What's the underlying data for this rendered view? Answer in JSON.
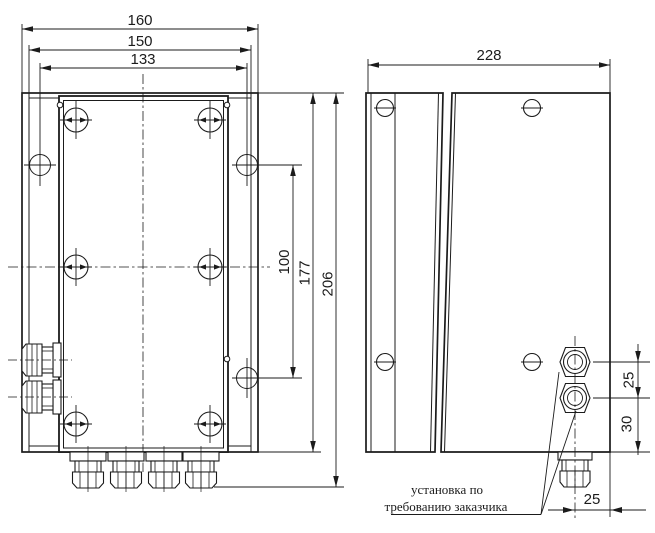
{
  "drawing": {
    "description": "Dimensional drawing of a junction box enclosure, front view and side view",
    "dims": {
      "d160": "160",
      "d150": "150",
      "d133": "133",
      "d100": "100",
      "d177": "177",
      "d206": "206",
      "d228": "228",
      "d25_gland_gap": "25",
      "d30_gland_bottom": "30",
      "d25_gland_edge": "25"
    },
    "note": {
      "line1": "установка по",
      "line2": "требованию заказчика"
    },
    "line_color": "#1b1b1b"
  }
}
